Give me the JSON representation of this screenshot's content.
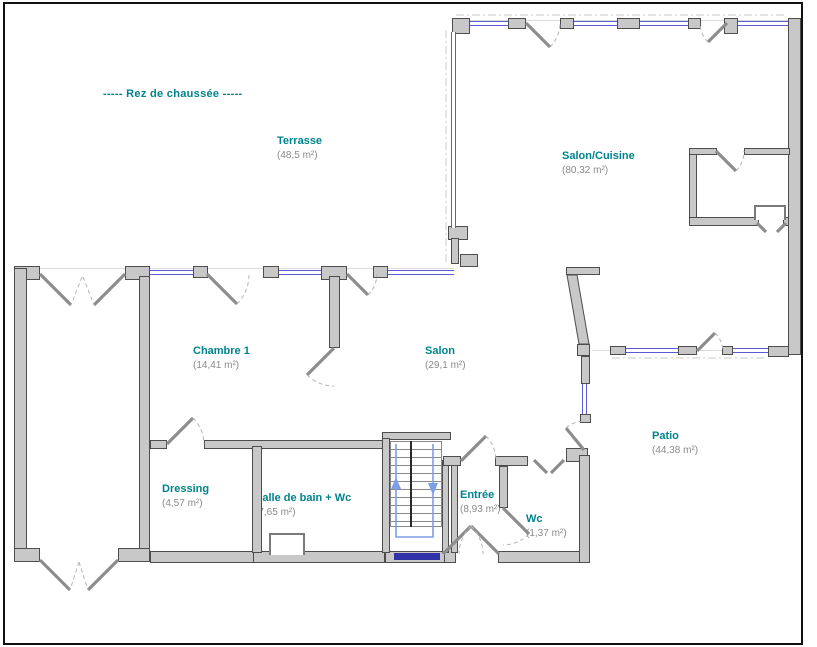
{
  "title": "-----  Rez de chaussée  -----",
  "colors": {
    "room_label": "#00838C",
    "area_label": "#8A8A8A",
    "wall_fill": "#C8C8C8",
    "wall_edge": "#4D4D4D",
    "window": "#5B5BD8",
    "window_dark": "#3333A8",
    "stairs_arrow": "#7D9FE6"
  },
  "rooms": [
    {
      "name": "Terrasse",
      "area": "(48,5 m²)"
    },
    {
      "name": "Salon/Cuisine",
      "area": "(80,32 m²)"
    },
    {
      "name": "Chambre 1",
      "area": "(14,41 m²)"
    },
    {
      "name": "Salon",
      "area": "(29,1 m²)"
    },
    {
      "name": "Patio",
      "area": "(44,38 m²)"
    },
    {
      "name": "Dressing",
      "area": "(4,57 m²)"
    },
    {
      "name": "Salle de bain + Wc",
      "area": "(7,65 m²)"
    },
    {
      "name": "Entrée",
      "area": "(8,93 m²)"
    },
    {
      "name": "Wc",
      "area": "(1,37 m²)"
    }
  ]
}
